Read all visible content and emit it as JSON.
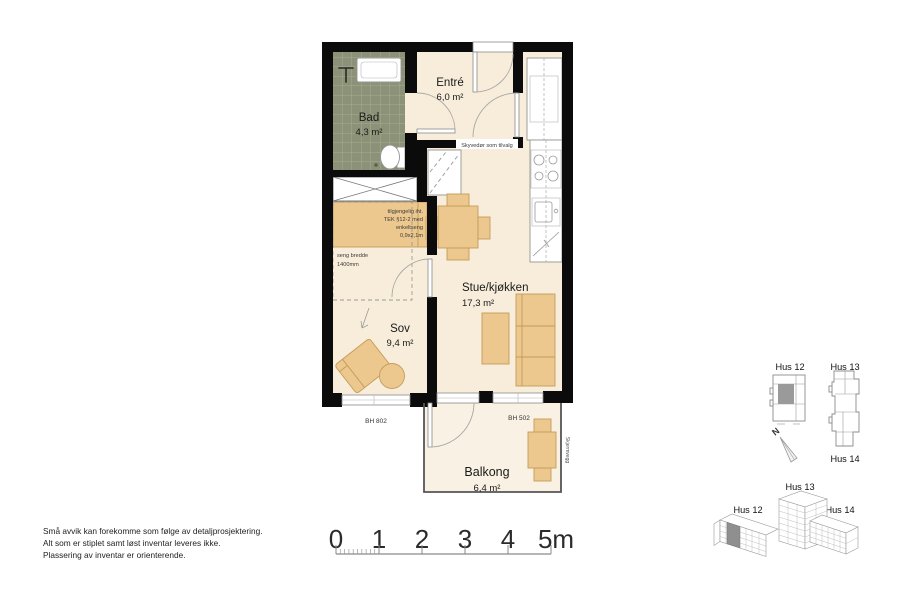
{
  "rooms": {
    "bad": {
      "name": "Bad",
      "area": "4,3 m²"
    },
    "entre": {
      "name": "Entré",
      "area": "6,0 m²"
    },
    "stue": {
      "name": "Stue/kjøkken",
      "area": "17,3 m²"
    },
    "sov": {
      "name": "Sov",
      "area": "9,4 m²"
    },
    "balkong": {
      "name": "Balkong",
      "area": "6,4 m²"
    }
  },
  "annotations": {
    "sliding_door": "Skyvedør som tilvalg",
    "accessibility": {
      "line1": "tilgjengelig iht.",
      "line2": "TEK §12-2 med",
      "line3": "enkeltseng",
      "line4": "0,9x2,1m"
    },
    "bed_width": {
      "line1": "seng bredde",
      "line2": "1400mm"
    },
    "sill_height_bedroom": "BH 802",
    "sill_height_balcony": "BH 502",
    "balcony_divider": "Skjermvegg"
  },
  "disclaimer": {
    "line1": "Små avvik kan forekomme som følge av detaljprosjektering.",
    "line2": "Alt som er stiplet samt løst inventar leveres ikke.",
    "line3": "Plassering av inventar er orienterende."
  },
  "scale_bar": {
    "t0": "0",
    "t1": "1",
    "t2": "2",
    "t3": "3",
    "t4": "4",
    "t5": "5m"
  },
  "site_locator": {
    "hus12": "Hus 12",
    "hus13": "Hus 13",
    "hus14": "Hus 14",
    "north": "N"
  },
  "iso_locator": {
    "hus12": "Hus 12",
    "hus13": "Hus 13",
    "hus14": "Hus 14"
  },
  "colors": {
    "wall": "#0b0b0b",
    "floor": "#f8edda",
    "furniture": "#ecc88f",
    "bath_tile": "#8c9277",
    "unit_highlight": "#9a9a9a"
  }
}
